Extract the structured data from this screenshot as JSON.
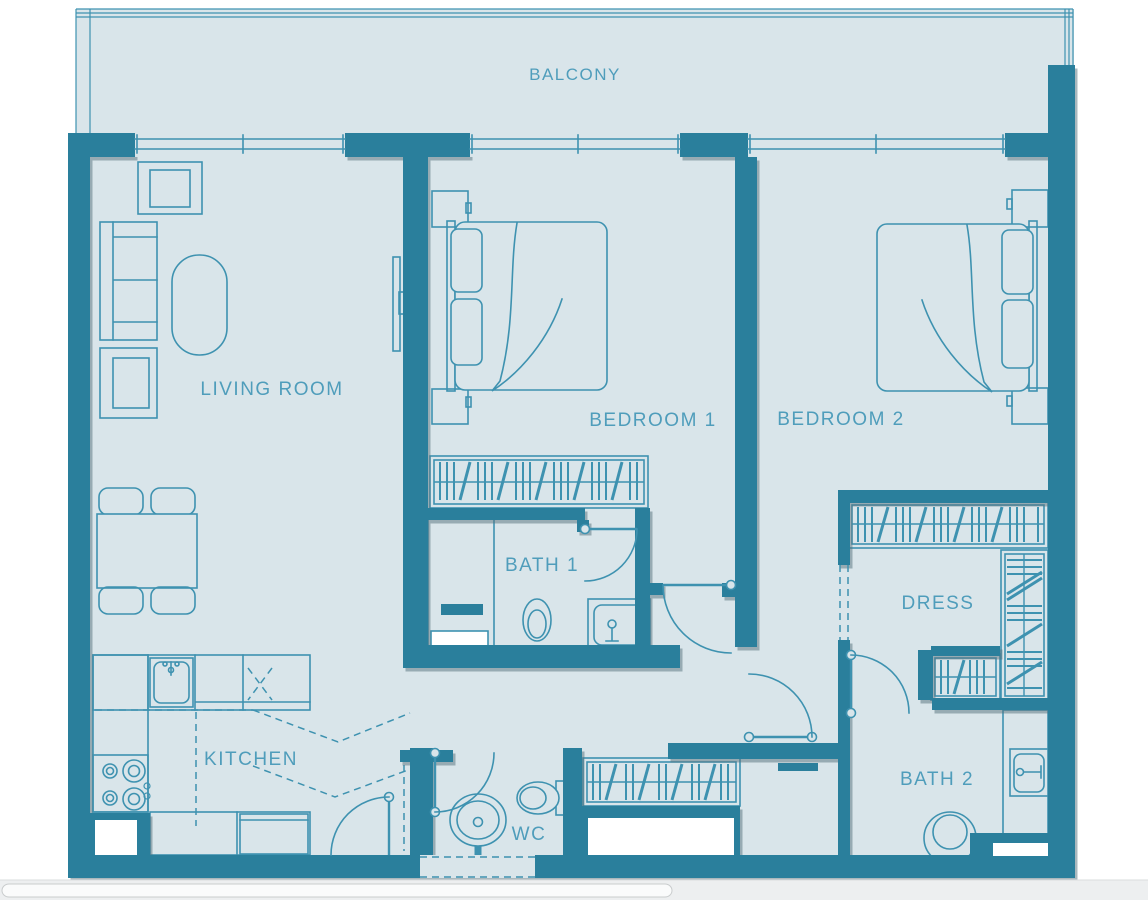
{
  "colors": {
    "wall": "#2b7f9c",
    "floor": "#d9e5ea",
    "line": "#3e92b0",
    "label": "#4f9dbb",
    "white": "#ffffff",
    "page": "#ffffff",
    "scroll-track": "#edeff0",
    "scroll-thumb": "#fafbfb",
    "scroll-border": "#c9cccd",
    "scroll-hairline": "#dadcde"
  },
  "plan": {
    "type": "apartment-floor-plan",
    "rooms": [
      {
        "id": "balcony",
        "label": "BALCONY"
      },
      {
        "id": "living-room",
        "label": "LIVING ROOM"
      },
      {
        "id": "bedroom-1",
        "label": "BEDROOM 1"
      },
      {
        "id": "bedroom-2",
        "label": "BEDROOM 2"
      },
      {
        "id": "bath-1",
        "label": "BATH 1"
      },
      {
        "id": "dress",
        "label": "DRESS"
      },
      {
        "id": "kitchen",
        "label": "KITCHEN"
      },
      {
        "id": "wc",
        "label": "WC"
      },
      {
        "id": "bath-2",
        "label": "BATH 2"
      }
    ],
    "furniture": [
      "sofa",
      "armchair",
      "coffee-table",
      "tv",
      "dining-table",
      "dining-chairs",
      "double-bed-1",
      "double-bed-2",
      "nightstands",
      "wardrobe",
      "shoe-closet",
      "kitchen-counter",
      "kitchen-sink",
      "stove",
      "fridge",
      "toilet",
      "wash-basin",
      "shower",
      "bath-sink"
    ]
  },
  "scrollbar": {
    "orientation": "horizontal",
    "thumb_start_frac": 0.0,
    "thumb_len_frac": 0.585
  }
}
